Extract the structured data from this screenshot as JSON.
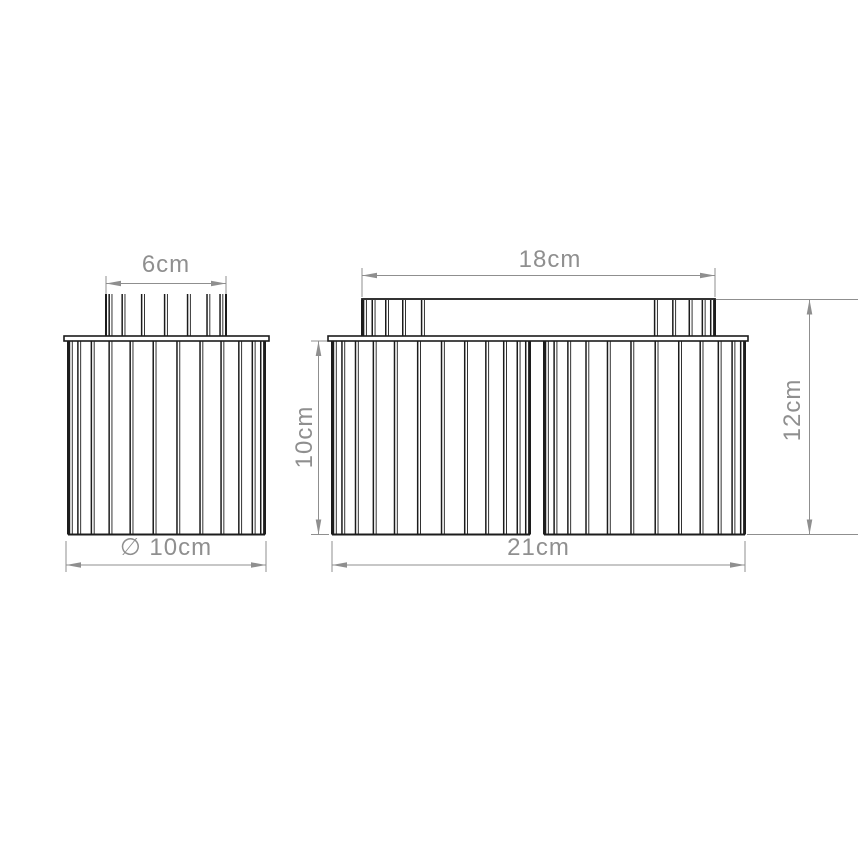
{
  "drawing_type": "technical-dimension-drawing",
  "colors": {
    "background": "#ffffff",
    "outline": "#1c1c1c",
    "dimension": "#8f8f8f"
  },
  "dimensions": {
    "left_fixture": {
      "top_width": "6cm",
      "diameter": "∅ 10cm"
    },
    "right_fixture": {
      "bar_width": "18cm",
      "shade_height": "10cm",
      "total_height": "12cm",
      "total_width": "21cm"
    }
  }
}
